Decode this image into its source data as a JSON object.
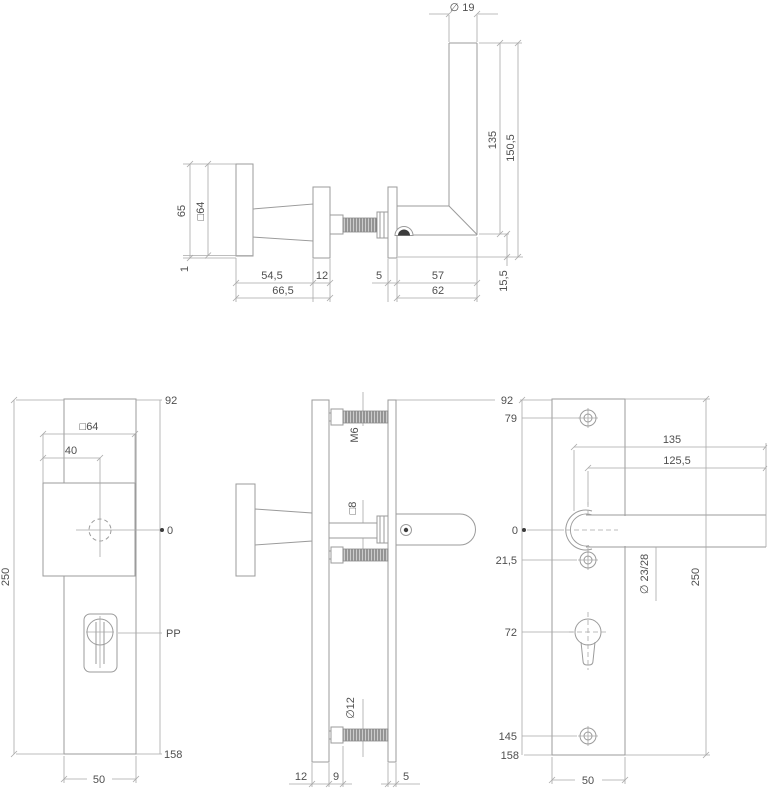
{
  "drawing_type": "door-handle-security-plate-technical-drawing",
  "colors": {
    "line": "#9b9b9b",
    "dim_line": "#a9a9a9",
    "text": "#4f4f4f",
    "screw_dark": "#3c3c3c",
    "background": "#ffffff"
  },
  "views": {
    "side": {
      "dia19": "∅ 19",
      "h135": "135",
      "h1505": "150,5",
      "k65": "65",
      "sq64": "□64",
      "one": "1",
      "w545": "54,5",
      "w12": "12",
      "w5": "5",
      "w57": "57",
      "h155": "15,5",
      "w665": "66,5",
      "w62": "62"
    },
    "front": {
      "d92": "92",
      "sq64": "□64",
      "w40": "40",
      "zero": "0",
      "pp": "PP",
      "h250": "250",
      "d158": "158",
      "w50": "50"
    },
    "section": {
      "m6": "M6",
      "sq8": "□8",
      "dia12": "∅12",
      "w12": "12",
      "w9": "9",
      "w5": "5"
    },
    "back": {
      "d92": "92",
      "d79": "79",
      "l135": "135",
      "l1255": "125,5",
      "zero": "0",
      "d215": "21,5",
      "dia2328": "∅ 23/28",
      "h250": "250",
      "d72": "72",
      "d145": "145",
      "d158": "158",
      "w50": "50"
    }
  }
}
